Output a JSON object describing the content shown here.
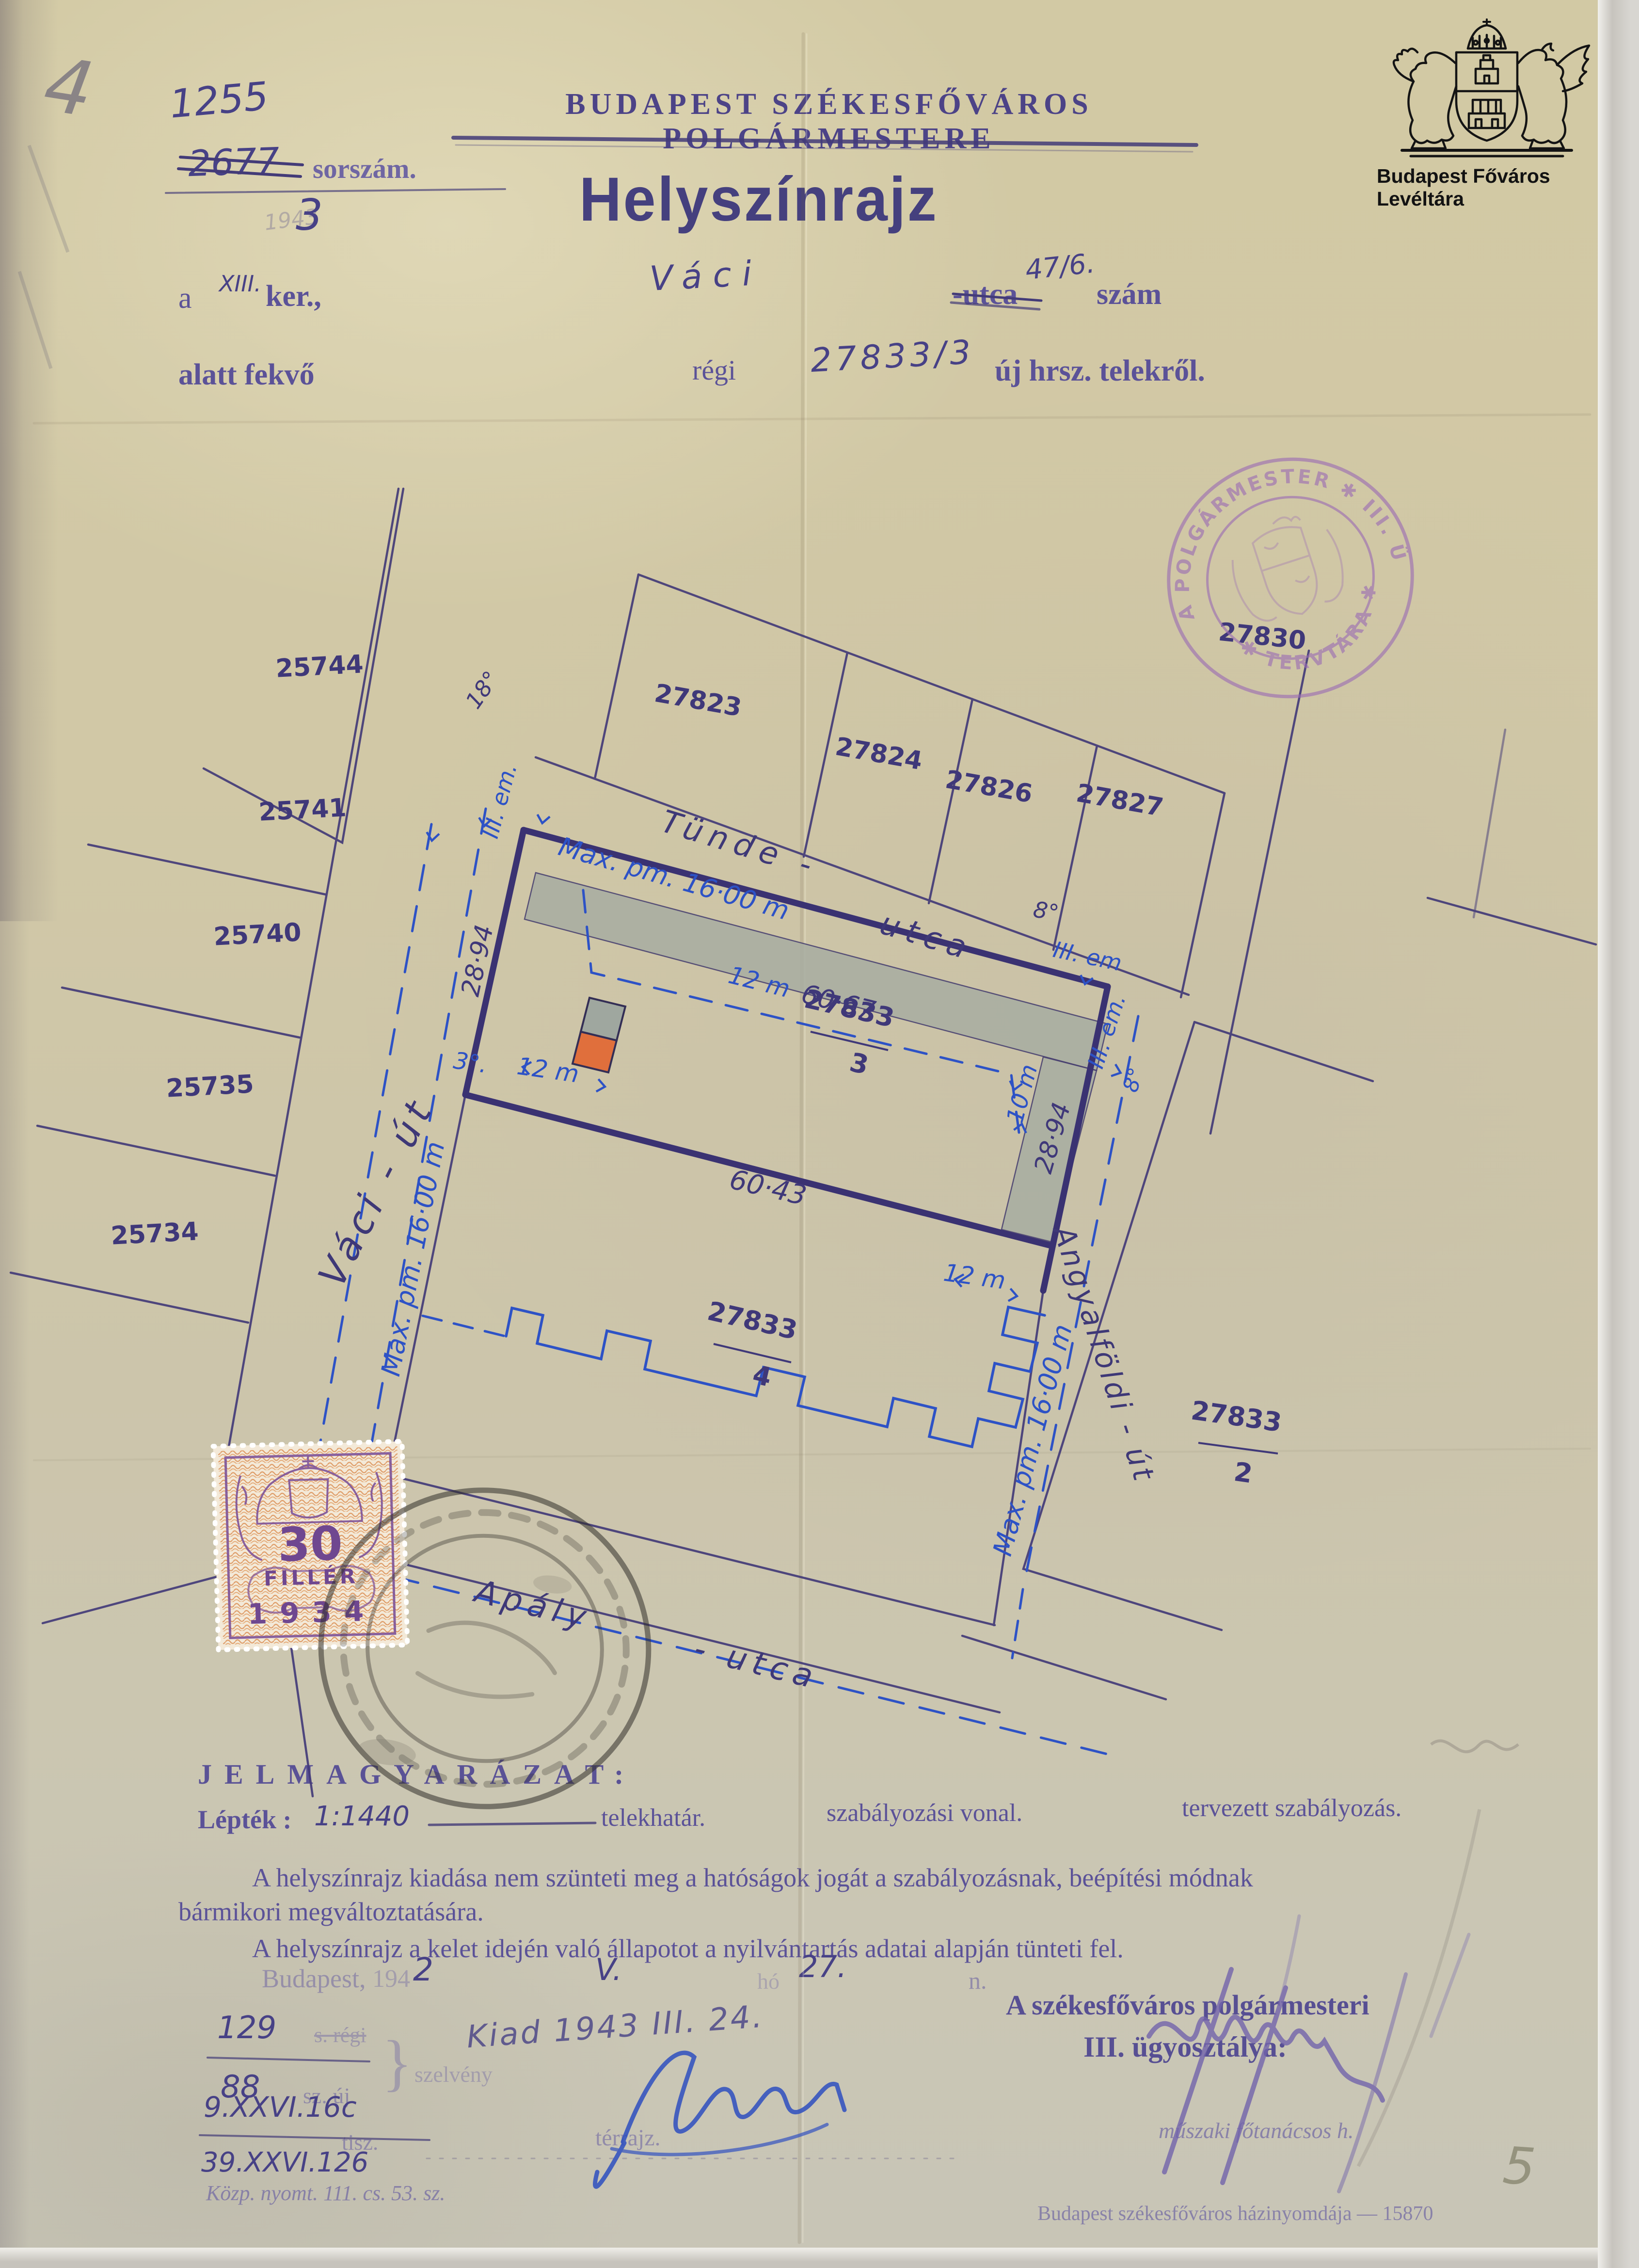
{
  "page": {
    "corner_mark": "4",
    "page_mark": "5"
  },
  "archive": {
    "name": "Budapest Főváros Levéltára"
  },
  "serial": {
    "number": "1255",
    "crossed": "2677",
    "label": "sorszám.",
    "year_ghost": "1943",
    "sub": "3"
  },
  "header": {
    "office": "BUDAPEST SZÉKESFŐVÁROS POLGÁRMESTERE",
    "title": "Helyszínrajz"
  },
  "subject": {
    "a": "a",
    "district": "XIII.",
    "ker": "ker.,",
    "street": "Váci",
    "utca_printed": "-utca",
    "house": "47/6.",
    "szam": "szám",
    "alatt": "alatt fekvő",
    "regi": "régi",
    "parcel": "27833/3",
    "uj": "új hrsz. telekről."
  },
  "map": {
    "streets": {
      "tunde_a": "Tünde -",
      "tunde_b": "utca",
      "vaci": "Váci - út",
      "apaly_a": "Apály",
      "apaly_b": "- utca",
      "angyalfoldi": "Angyalföldi - út"
    },
    "plots": {
      "p25744": "25744",
      "p25741": "25741",
      "p25740": "25740",
      "p25735": "25735",
      "p25734": "25734",
      "p27823": "27823",
      "p27824": "27824",
      "p27826": "27826",
      "p27827": "27827",
      "p27830": "27830"
    },
    "parcels": {
      "a_num": "27833",
      "a_den": "3",
      "b_num": "27833",
      "b_den": "4",
      "c_num": "27833",
      "c_den": "2"
    },
    "dims": {
      "maxpm": "Max. pm. 16·00 m",
      "d12": "12 m",
      "d10": "10 m",
      "d6067": "60·67",
      "d6043": "60·43",
      "d2894": "28·94",
      "d3deg": "3°.",
      "deg8": "8°",
      "deg18": "18°",
      "iii_em": "III. em.",
      "iii_em2": "III. em"
    }
  },
  "stamps": {
    "tervtar_top": "A POLGÁRMESTER ✱ III. ÜGYOSZTÁLY",
    "tervtar_bottom": "✱ TERVTÁRA ✱",
    "revenue_value": "30",
    "revenue_currency": "FILLÉR",
    "revenue_year": "1934"
  },
  "legend": {
    "heading": "JELMAGYARÁZAT:",
    "scale_word": "Lépték :",
    "scale_value": "1:1440",
    "item_boundary": "telekhatár.",
    "item_regulation": "szabályozási vonal.",
    "item_planned": "tervezett szabályozás.",
    "para1a": "A helyszínrajz kiadása nem szünteti meg a hatóságok jogát a szabályozásnak, beépítési módnak",
    "para1b": "bármikori megváltoztatására.",
    "para2": "A helyszínrajz a kelet idején való állapotot a nyilvántartás adatai alapján tünteti fel."
  },
  "footer": {
    "city": "Budapest,",
    "year_printed": "194",
    "year_hand": "2",
    "month": "V.",
    "ho": "hó",
    "day": "27.",
    "n": "n.",
    "old_num": "129",
    "old_suffix": "s. régi",
    "new_num": "88",
    "new_suffix": "sz. új",
    "brace": "}",
    "szelveny": "szelvény",
    "kiad": "Kiad 1943 III. 24.",
    "file1": "9.XXVI.16c",
    "tisz": "tisz.",
    "file2": "39.XXVI.126",
    "terrajz": "térrajz.",
    "dept1": "A székesfőváros polgármesteri",
    "dept2": "III. ügyosztálya:",
    "signer": "műszaki főtanácsos h.",
    "printer_left": "Közp. nyomt. 111. cs. 53. sz.",
    "printer_right": "Budapest székesfőváros házinyomdája — 15870"
  }
}
